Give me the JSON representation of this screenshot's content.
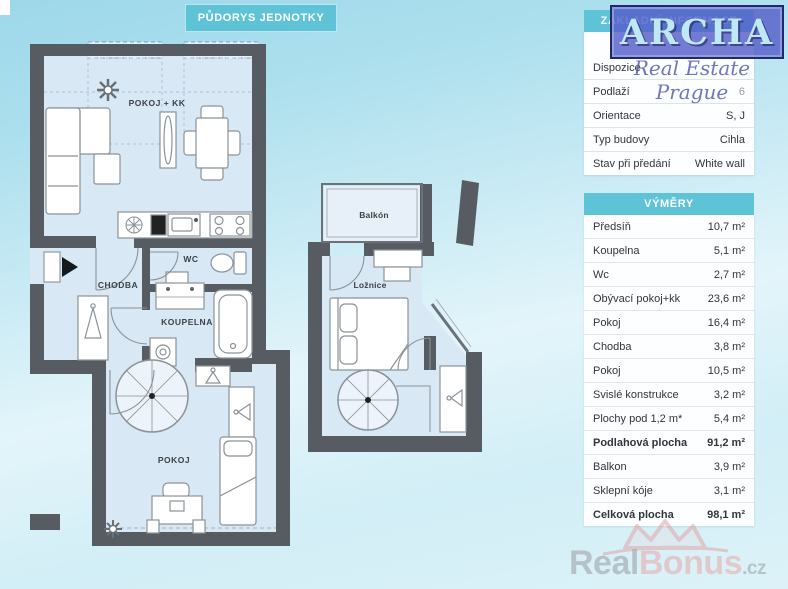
{
  "header": {
    "plan_title": "PŮDORYS JEDNOTKY"
  },
  "logo": {
    "name": "ARCHA",
    "tagline": "Real Estate Prague"
  },
  "info_table": {
    "title": "ZÁKLADNÍ INFORMACE",
    "rows": [
      {
        "label": "Dispozice",
        "value": ""
      },
      {
        "label": "Podlaží",
        "value": "6"
      },
      {
        "label": "Orientace",
        "value": "S, J"
      },
      {
        "label": "Typ budovy",
        "value": "Cihla"
      },
      {
        "label": "Stav při předání",
        "value": "White wall"
      }
    ]
  },
  "area_table": {
    "title": "VÝMĚRY",
    "rows": [
      {
        "label": "Předsíň",
        "value": "10,7 m²"
      },
      {
        "label": "Koupelna",
        "value": "5,1 m²"
      },
      {
        "label": "Wc",
        "value": "2,7 m²"
      },
      {
        "label": "Obývací pokoj+kk",
        "value": "23,6 m²"
      },
      {
        "label": "Pokoj",
        "value": "16,4 m²"
      },
      {
        "label": "Chodba",
        "value": "3,8 m²"
      },
      {
        "label": "Pokoj",
        "value": "10,5 m²"
      },
      {
        "label": "Svislé konstrukce",
        "value": "3,2 m²"
      },
      {
        "label": "Plochy pod 1,2 m*",
        "value": "5,4 m²"
      },
      {
        "label": "Podlahová plocha",
        "value": "91,2 m²"
      },
      {
        "label": "Balkon",
        "value": "3,9 m²"
      },
      {
        "label": "Sklepní kóje",
        "value": "3,1 m²"
      },
      {
        "label": "Celková plocha",
        "value": "98,1 m²"
      }
    ]
  },
  "floorplan": {
    "lower": {
      "living": "POKOJ + KK",
      "wc": "WC",
      "hall": "CHODBA",
      "bath": "KOUPELNA",
      "room": "POKOJ"
    },
    "upper": {
      "balcony": "Balkón",
      "bedroom": "Ložnice"
    }
  },
  "watermark": {
    "part1": "Real",
    "part2": "Bonus",
    "part3": ".cz"
  },
  "colors": {
    "accent_teal": "#5fc3d8",
    "wall": "#575c62",
    "room_fill": "#d9e8f5",
    "logo_blue": "#565ec4"
  }
}
